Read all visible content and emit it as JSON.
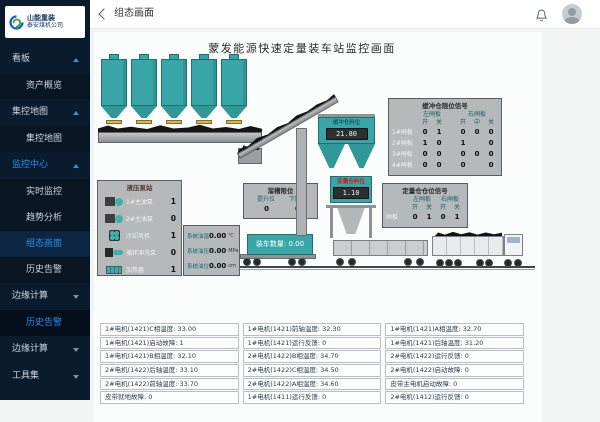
{
  "sidebar": {
    "logo_line1": "山能重装",
    "logo_line2": "泰安煤机公司",
    "items": [
      {
        "label": "看板"
      },
      {
        "label": "资产概览"
      },
      {
        "label": "集控地图"
      },
      {
        "label": "集控地图"
      },
      {
        "label": "监控中心"
      },
      {
        "label": "实时监控"
      },
      {
        "label": "趋势分析"
      },
      {
        "label": "组态画面"
      },
      {
        "label": "历史告警"
      },
      {
        "label": "边缘计算"
      },
      {
        "label": "历史告警"
      },
      {
        "label": "边缘计算"
      },
      {
        "label": "工具集"
      }
    ]
  },
  "topbar": {
    "title": "组态画面"
  },
  "screen": {
    "title": "蒙发能源快速定量装车站监控画面",
    "buffer_bin_label": "缓冲仓料位",
    "buffer_bin_value": "21.80",
    "weigh_bin_label": "定量仓料位",
    "weigh_bin_value": "1.10",
    "load_count_label": "装车数量:",
    "load_count_value": "0.00"
  },
  "pump_station": {
    "title": "液压泵站",
    "rows": [
      {
        "icon": "pump-icon",
        "label": "1#主油泵",
        "value": "1"
      },
      {
        "icon": "pump-icon",
        "label": "2#主油泵",
        "value": "0"
      },
      {
        "icon": "fan-icon",
        "label": "冷却风机",
        "value": "1"
      },
      {
        "icon": "wash-pump-icon",
        "label": "循环冲洗泵",
        "value": "0"
      },
      {
        "icon": "heater-icon",
        "label": "加热器",
        "value": "1"
      }
    ]
  },
  "chute_limit": {
    "title": "溜槽限位",
    "cols": [
      "提升位",
      "下降位"
    ],
    "values": [
      "0",
      "0"
    ]
  },
  "oil_system": {
    "rows": [
      {
        "label": "系统油温",
        "value": "0.00",
        "unit": "℃"
      },
      {
        "label": "系统油压",
        "value": "0.00",
        "unit": "MPa"
      },
      {
        "label": "系统油位",
        "value": "0.00",
        "unit": "cm"
      }
    ]
  },
  "buffer_limit": {
    "title": "缓冲仓限位信号",
    "group_left": "左闸板",
    "group_right": "右闸板",
    "sub": [
      "开",
      "关",
      "开",
      "中",
      "关"
    ],
    "rows": [
      {
        "label": "1#闸板",
        "values": [
          "0",
          "1",
          "0",
          "0",
          "0"
        ]
      },
      {
        "label": "2#闸板",
        "values": [
          "1",
          "0",
          "1",
          "",
          "0"
        ]
      },
      {
        "label": "3#闸板",
        "values": [
          "0",
          "0",
          "0",
          "0",
          "0"
        ]
      },
      {
        "label": "4#闸板",
        "values": [
          "0",
          "0",
          "0",
          "",
          "0"
        ]
      }
    ]
  },
  "weigh_limit": {
    "title": "定量仓仓位信号",
    "group_left": "左闸板",
    "group_right": "右闸板",
    "sub": [
      "开",
      "关",
      "开",
      "关"
    ],
    "row_label": "闸板",
    "values": [
      "0",
      "1",
      "0",
      "1"
    ]
  },
  "bottom_table": {
    "rows": [
      [
        "1#电机(1421)C相温度: 33.00",
        "1#电机(1421)前轴温度: 32.30",
        "1#电机(1421)A相温度: 32.70"
      ],
      [
        "1#电机(1421)启动故障: 1",
        "1#电机(1421)运行反馈: 0",
        "1#电机(1421)后轴温度: 31.20"
      ],
      [
        "1#电机(1421)B相温度: 32.10",
        "2#电机(1422)B相温度: 34.70",
        "2#电机(1422)运行反馈: 0"
      ],
      [
        "2#电机(1422)后轴温度: 33.10",
        "2#电机(1422)C相温度: 34.50",
        "2#电机(1422)启动故障: 0"
      ],
      [
        "2#电机(1422)前轴温度: 33.70",
        "2#电机(1422)A相温度: 34.60",
        "皮带主电机启动故障: 0"
      ],
      [
        "皮带就地故障: 0",
        "1#电机(1411)运行反馈: 0",
        "2#电机(1412)运行反馈: 0"
      ]
    ]
  }
}
